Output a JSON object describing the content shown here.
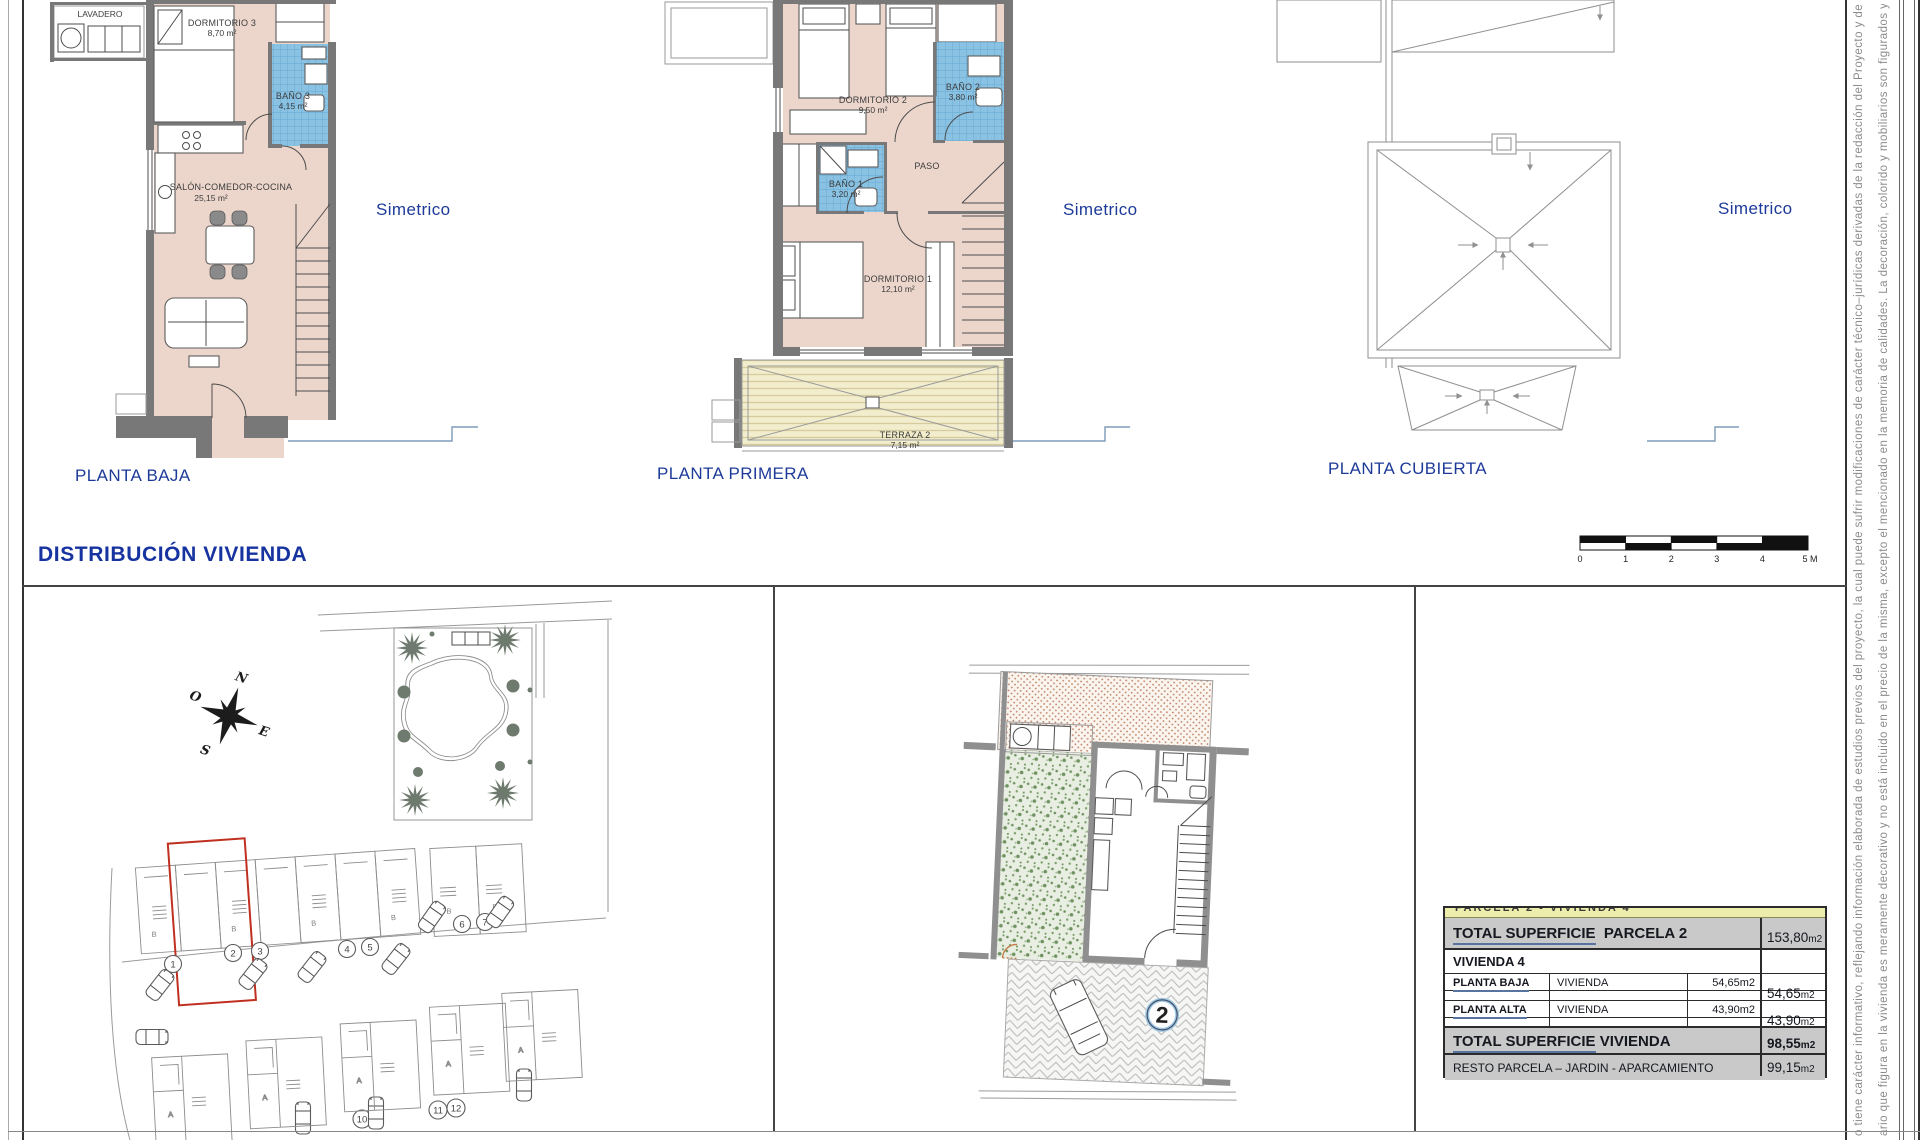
{
  "plans": {
    "baja": {
      "label": "PLANTA BAJA",
      "simetrico": "Simetrico",
      "rooms": {
        "lavadero": {
          "name": "LAVADERO"
        },
        "dormitorio3": {
          "name": "DORMITORIO 3",
          "area": "8,70 m²"
        },
        "bano3": {
          "name": "BAÑO 3",
          "area": "4,15 m²"
        },
        "salon": {
          "name": "SALÓN-COMEDOR-COCINA",
          "area": "25,15 m²"
        }
      }
    },
    "primera": {
      "label": "PLANTA PRIMERA",
      "simetrico": "Simetrico",
      "rooms": {
        "dormitorio2": {
          "name": "DORMITORIO 2",
          "area": "9,50 m²"
        },
        "bano2": {
          "name": "BAÑO 2",
          "area": "3,80 m²"
        },
        "bano1": {
          "name": "BAÑO 1",
          "area": "3,20 m²"
        },
        "paso": {
          "name": "PASO"
        },
        "dormitorio1": {
          "name": "DORMITORIO 1",
          "area": "12,10 m²"
        },
        "terraza2": {
          "name": "TERRAZA 2",
          "area": "7,15 m²"
        }
      }
    },
    "cubierta": {
      "label": "PLANTA CUBIERTA",
      "simetrico": "Simetrico"
    }
  },
  "section_title": "DISTRIBUCIÓN  VIVIENDA",
  "scale_bar": {
    "ticks": [
      "0",
      "1",
      "2",
      "3",
      "4",
      "5 M"
    ]
  },
  "site_plan": {
    "compass": {
      "north": "N",
      "east": "E",
      "south": "S",
      "west": "O"
    },
    "plot_numbers": [
      "1",
      "2",
      "3",
      "4",
      "5",
      "6",
      "7"
    ],
    "lower_plot_numbers": [
      "10",
      "11",
      "12"
    ],
    "house_letter_b": "B",
    "house_letter_a": "A"
  },
  "parcel_detail": {
    "plot_number": "2"
  },
  "summary_table": {
    "clipped_title": "PARCELA 2  -  VIVIENDA 4",
    "row_total_parcela": {
      "label_u": "TOTAL  SUPERFICIE",
      "label_rest": "PARCELA  2",
      "value": "153,80",
      "unit": "m2"
    },
    "row_vivienda": {
      "label": "VIVIENDA  4"
    },
    "row_planta_baja": {
      "label": "PLANTA  BAJA",
      "col2": "VIVIENDA",
      "col3": "54,65m2",
      "value": "54,65",
      "unit": "m2"
    },
    "row_planta_alta": {
      "label": "PLANTA  ALTA",
      "col2": "VIVIENDA",
      "col3": "43,90m2",
      "value": "43,90",
      "unit": "m2"
    },
    "row_total_vivienda": {
      "label_u": "TOTAL  SUPERFICIE",
      "label_rest": "VIVIENDA",
      "value": "98,55",
      "unit": "m2"
    },
    "row_resto": {
      "label": "RESTO PARCELA – JARDIN - APARCAMIENTO",
      "value": "99,15",
      "unit": "m2"
    }
  },
  "disclaimer": {
    "line1": "o tiene carácter informativo, reflejando información elaborada de estudios previos del proyecto, la cual puede sufrir modificaciones de carácter técnico–jurídicas derivadas de la redacción del Proyecto y de su",
    "line2": "ario que figura en la vivienda es meramente decorativo y no está incluido en el precio de la misma, excepto el mencionado en la memoria de calidades. La decoración, colorido y mobiliarios son figurados y n"
  }
}
